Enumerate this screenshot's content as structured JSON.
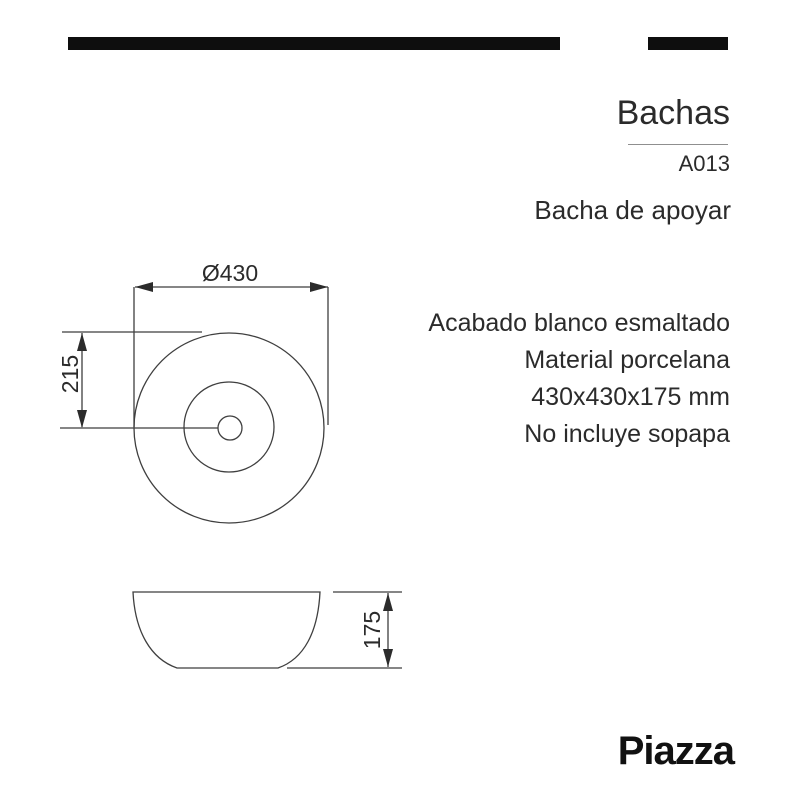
{
  "header": {
    "category": "Bachas",
    "code": "A013",
    "product_name": "Bacha de apoyar"
  },
  "specs": {
    "lines": [
      "Acabado blanco esmaltado",
      "Material porcelana",
      "430x430x175 mm",
      "No incluye sopapa"
    ]
  },
  "drawing": {
    "top_view": {
      "diameter_label": "Ø430",
      "radius_label": "215"
    },
    "side_view": {
      "height_label": "175"
    }
  },
  "brand": {
    "logo_text": "Piazza"
  },
  "colors": {
    "line": "#3f3f3f",
    "text": "#2b2b2b",
    "bar": "#0e0e0e"
  }
}
